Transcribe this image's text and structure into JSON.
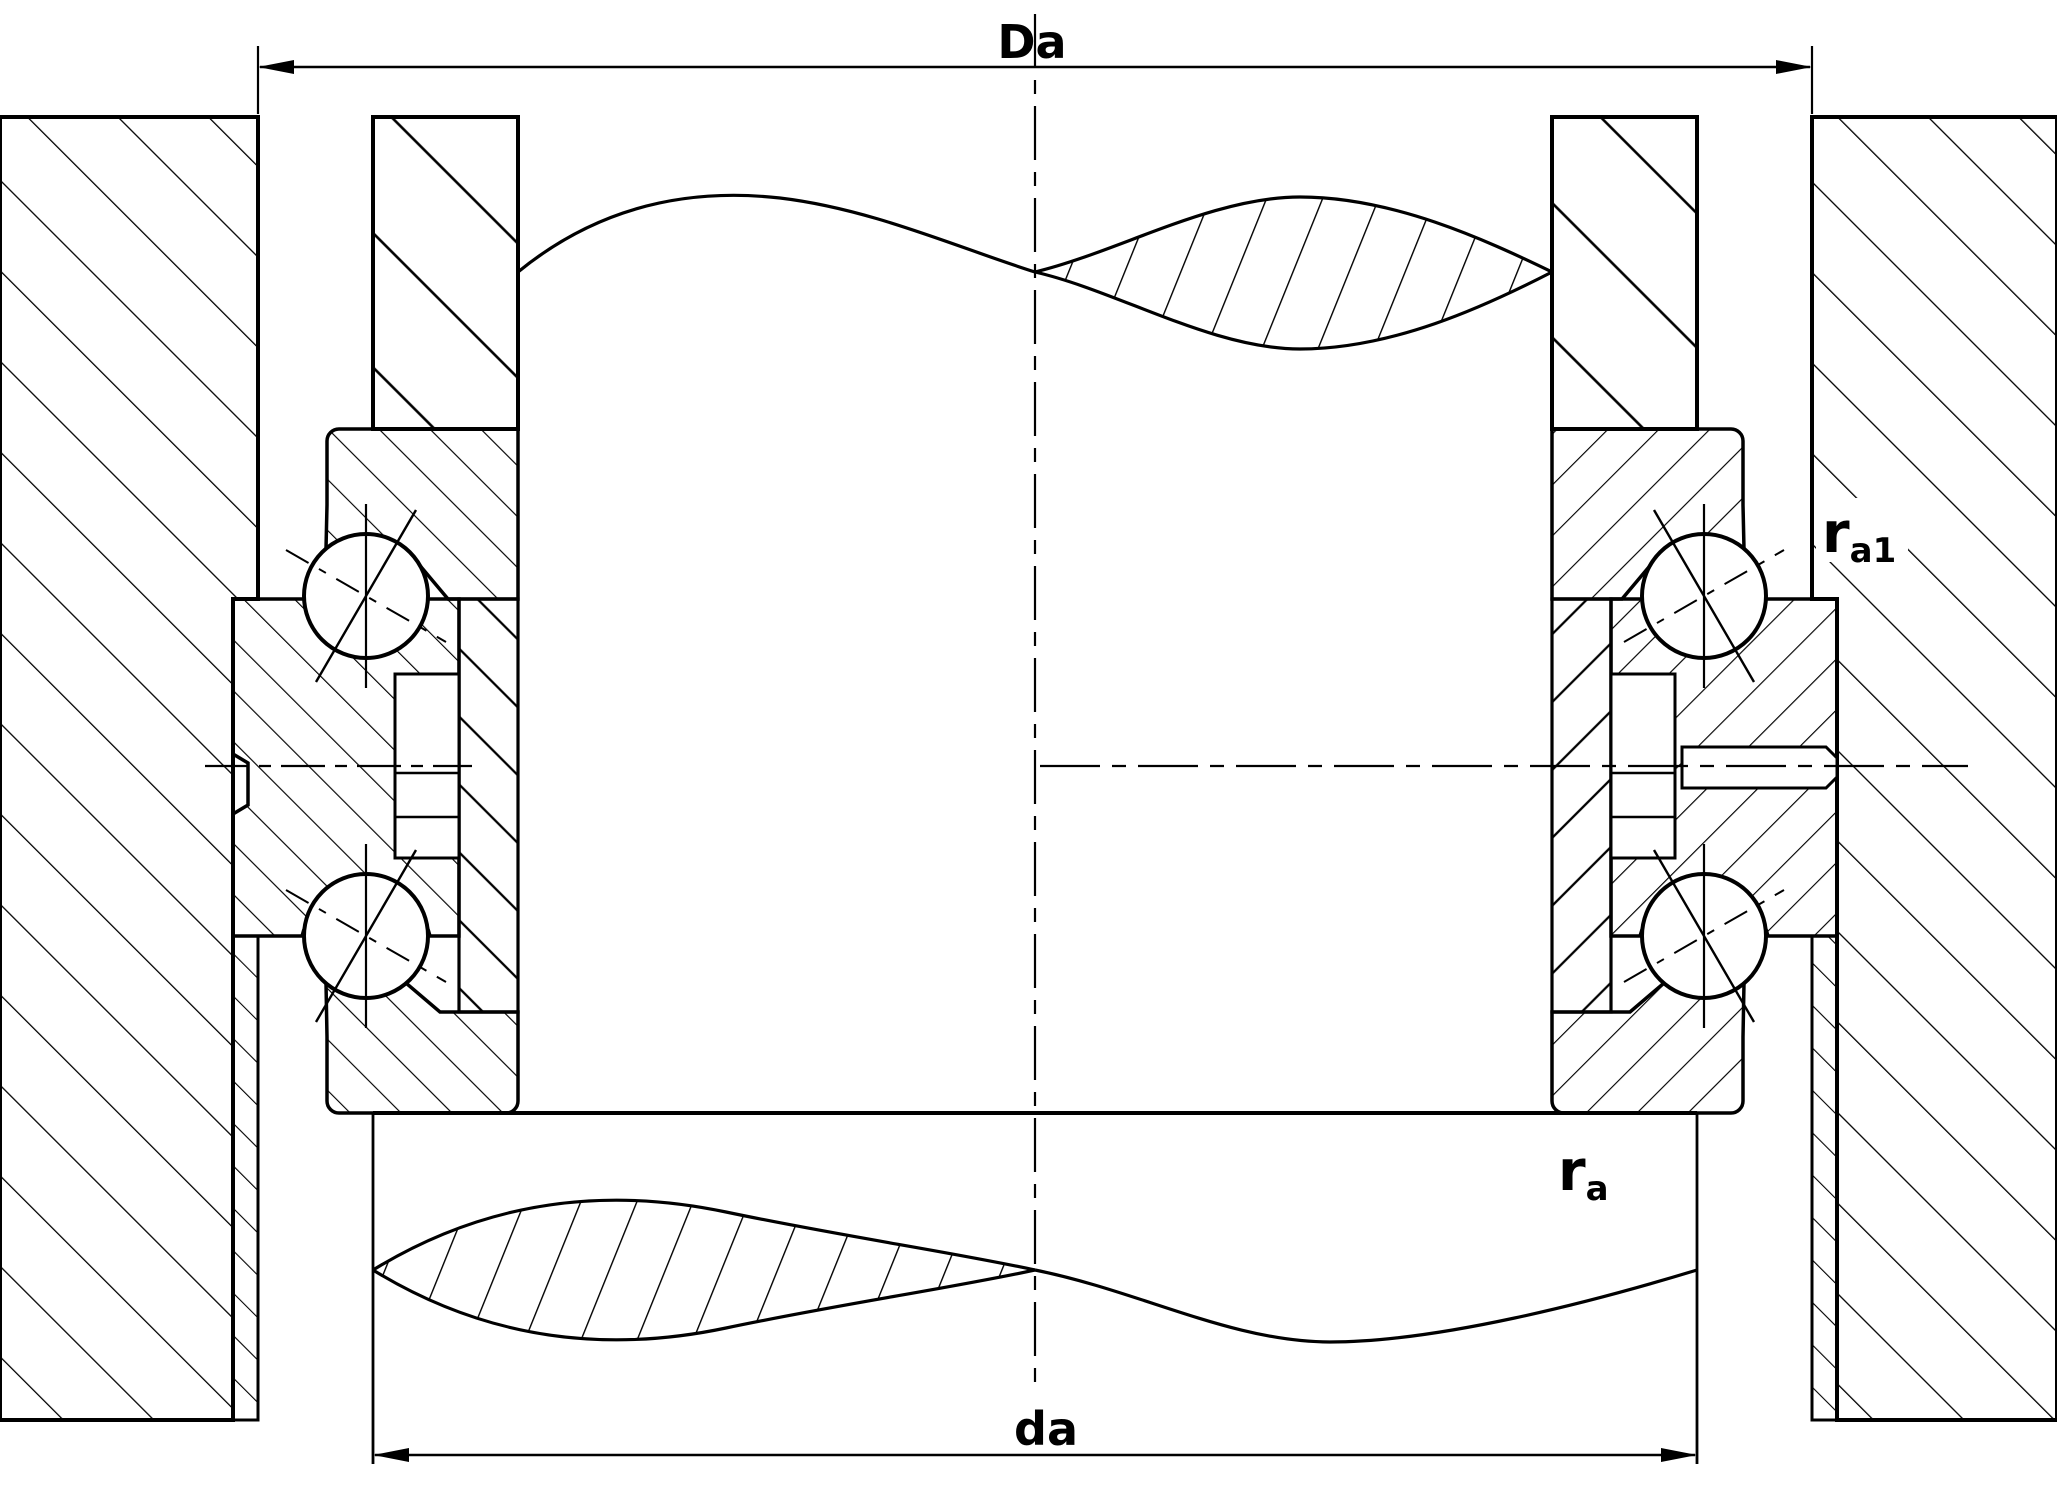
{
  "drawing": {
    "kind": "bearing-cross-section",
    "labels": {
      "dim_outer": "Da",
      "dim_inner": "da",
      "fillet_housing_base": "r",
      "fillet_housing_sub": "a1",
      "fillet_shaft_base": "r",
      "fillet_shaft_sub": "a"
    },
    "colors": {
      "line": "#000000",
      "background": "#ffffff"
    }
  }
}
